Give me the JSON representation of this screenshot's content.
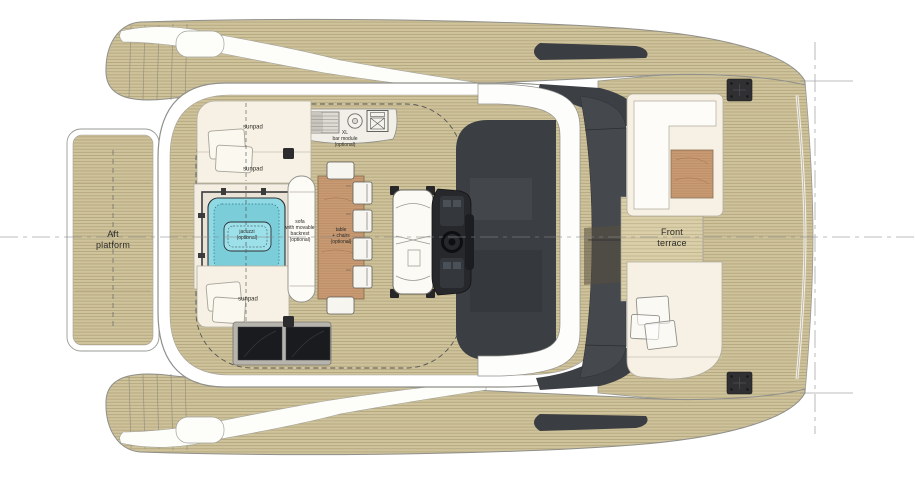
{
  "drawing": {
    "title": "Catamaran yacht flybridge deck plan (top view)",
    "labels": {
      "aft_platform": "Aft\nplatform",
      "front_terrace": "Front\nterrace",
      "sunpad_top": "sunpad",
      "sunpad_middle": "sunpad",
      "sunpad_bottom": "sunpad",
      "jacuzzi": "jacuzzi\n(optional)",
      "sofa": "sofa\nwith movable\nbackrest\n(optional)",
      "table_chairs": "table\n+ chairs\n(optional)",
      "bar_module": "XL\nbar module\n(optional)"
    },
    "colors": {
      "deck_wood": "#cfc39c",
      "plank_line": "#b3a67e",
      "terrace_wood": "#dacfa9",
      "upholstery_cream": "#f6f1e4",
      "structure_white": "#ffffff",
      "outline_gray": "#8f8f8b",
      "glass_dark": "#44474c",
      "console_dark": "#26282c",
      "jacuzzi_water": "#8fd9e4",
      "table_wood": "#c99b73",
      "cleat_dark": "#303033",
      "construction_line": "#8a8a8a"
    }
  }
}
